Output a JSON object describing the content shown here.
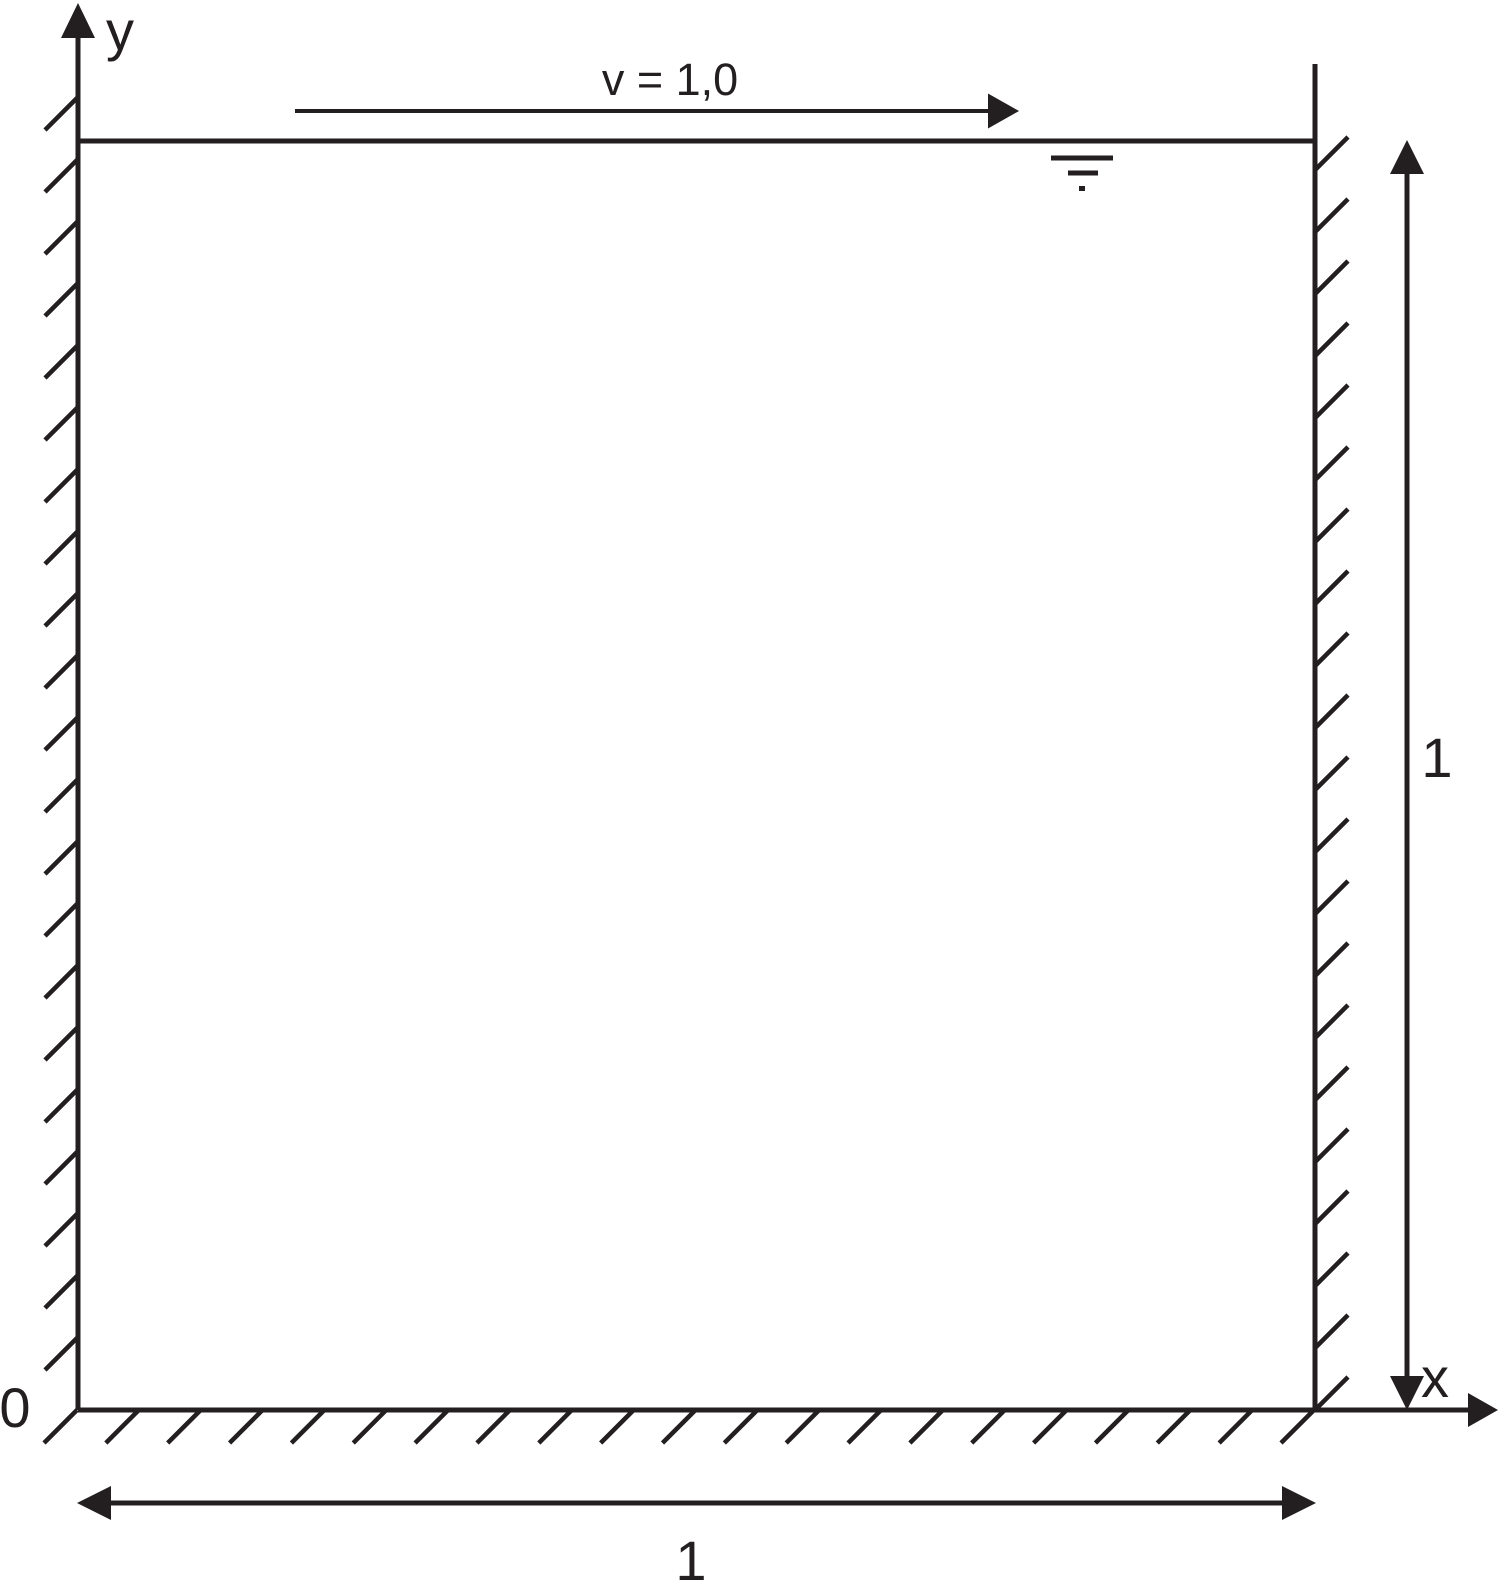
{
  "figure": {
    "axis_y_label": "y",
    "axis_x_label": "x",
    "origin_label": "0",
    "lid_velocity_label": "v = 1,0",
    "height_dimension_label": "1",
    "width_dimension_label": "1"
  },
  "colors": {
    "ink": "#231f20",
    "background": "#ffffff"
  }
}
